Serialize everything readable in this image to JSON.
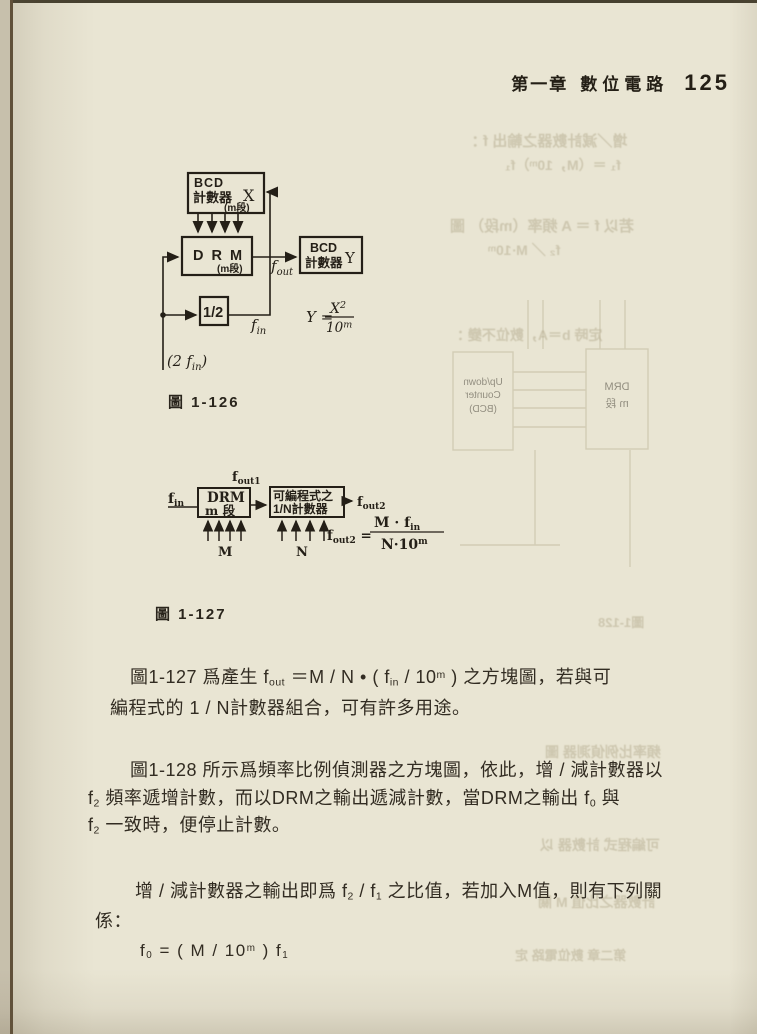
{
  "header": {
    "chapter": "第一章",
    "title": "數位電路",
    "page_number": "125"
  },
  "figure_126": {
    "caption": "圖 1-126",
    "bcd_x": {
      "line1": "BCD",
      "line2": "計數器",
      "var": "X",
      "stage": "(m段)"
    },
    "drm": {
      "label": "D R M",
      "stage": "(m段)"
    },
    "bcd_y": {
      "line1": "BCD",
      "line2": "計數器",
      "var": "Y"
    },
    "half_box": "1/2",
    "labels": {
      "fout_base": "f",
      "fout_sub": "out",
      "fin_base": "f",
      "fin_sub": "in",
      "input_open": "(2 ",
      "input_f": "f",
      "input_sub": "in",
      "input_close": ")"
    },
    "formula": {
      "lhs": "Y =",
      "num_base": "X",
      "num_sup": "2",
      "den_base": "10",
      "den_sup": "m"
    }
  },
  "figure_127": {
    "caption": "圖 1-127",
    "drm": {
      "line1": "DRM",
      "line2": "m 段"
    },
    "prog": {
      "line1": "可編程式之",
      "line2": "1/N計數器"
    },
    "labels": {
      "fin_base": "f",
      "fin_sub": "in",
      "fout1_base": "f",
      "fout1_sub": "out1",
      "fout2_base": "f",
      "fout2_sub": "out2",
      "m": "M",
      "n": "N"
    },
    "formula": {
      "lhs_base": "f",
      "lhs_sub": "out2",
      "lhs_eq": " =",
      "num_base": "M · f",
      "num_sub": "in",
      "den_base": "N·10",
      "den_sup": "m"
    }
  },
  "paragraphs": {
    "p1_line1_parts": [
      {
        "t": "圖1-127 爲產生 f"
      },
      {
        "t": "out",
        "s": "sub"
      },
      {
        "t": " ＝M / N • ( f"
      },
      {
        "t": "in",
        "s": "sub"
      },
      {
        "t": " / 10"
      },
      {
        "t": "m",
        "s": "sup"
      },
      {
        "t": " ) 之方塊圖，若與可"
      }
    ],
    "p1_line2": "編程式的 1 / N計數器組合，可有許多用途。",
    "p2_line1": "圖1-128 所示爲頻率比例偵測器之方塊圖，依此，增 / 減計數器以",
    "p2_line2_parts": [
      {
        "t": "f"
      },
      {
        "t": "2",
        "s": "sub"
      },
      {
        "t": " 頻率遞增計數，而以DRM之輸出遞減計數，當DRM之輸出 f"
      },
      {
        "t": "0",
        "s": "sub"
      },
      {
        "t": " 與"
      }
    ],
    "p2_line3_parts": [
      {
        "t": "f"
      },
      {
        "t": "2",
        "s": "sub"
      },
      {
        "t": " 一致時，便停止計數。"
      }
    ],
    "p3_line1_parts": [
      {
        "t": "增 / 減計數器之輸出即爲 f"
      },
      {
        "t": "2",
        "s": "sub"
      },
      {
        "t": " / f"
      },
      {
        "t": "1",
        "s": "sub"
      },
      {
        "t": " 之比值，若加入M值，則有下列關"
      }
    ],
    "p3_line2": "係：",
    "p3_formula_parts": [
      {
        "t": "f"
      },
      {
        "t": "0",
        "s": "sub"
      },
      {
        "t": " = ( M / 10"
      },
      {
        "t": "m",
        "s": "sup"
      },
      {
        "t": " ) f"
      },
      {
        "t": "1",
        "s": "sub"
      }
    ]
  },
  "bleedthrough": {
    "rows": [
      "增／減計數器之輸出 f ：",
      "f₁ ＝（M，10ᵐ）f₁",
      "若以 f ＝ A 頻率（m段） 圖",
      "f₂ ／ M·10ᵐ",
      "定時 b＝A，數位不變 ：",
      "圖1-128",
      "頻率比例偵測器 圖",
      "可編程式 計數器 以",
      "計數器之比值 M 關",
      "第二章 數位電路 定"
    ],
    "ghost_left_box": [
      "Up/down",
      "Counter",
      "(BCD)"
    ],
    "ghost_right_box": [
      "DRM",
      "m 段"
    ]
  }
}
